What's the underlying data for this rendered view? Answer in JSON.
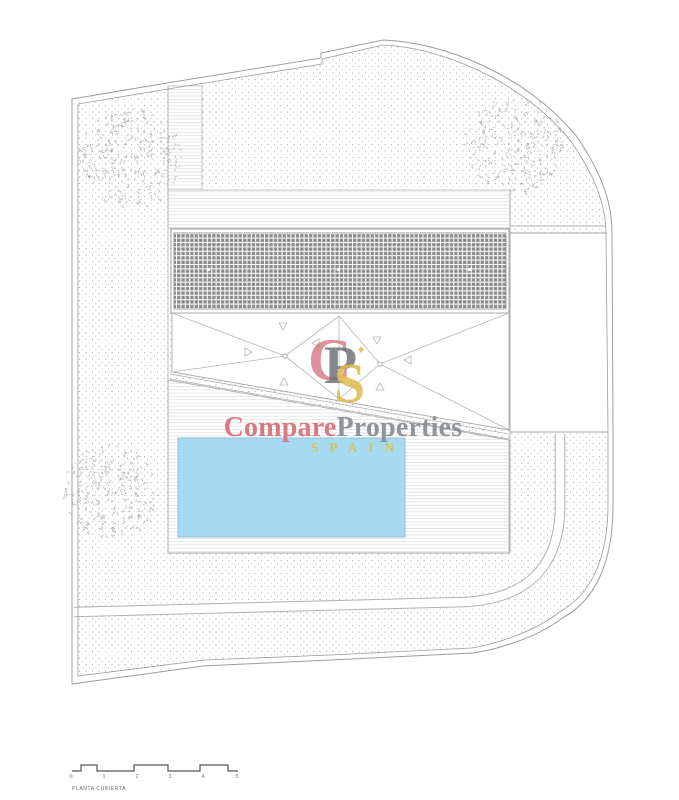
{
  "watermark": {
    "brand_part1": "Compare",
    "brand_part2": "Properties",
    "brand_sub": "SPAIN",
    "monogram_c": "C",
    "monogram_p": "P",
    "monogram_s": "S",
    "monogram_star": "✦",
    "color_red": "#d5737c",
    "color_gray": "#8b9094",
    "color_gold": "#d9c25a"
  },
  "plan": {
    "title": "PLANTA CUBIERTA",
    "scale_ticks": [
      "0",
      "1",
      "2",
      "3",
      "4",
      "5"
    ],
    "pool_color": "#a6d9f2"
  }
}
